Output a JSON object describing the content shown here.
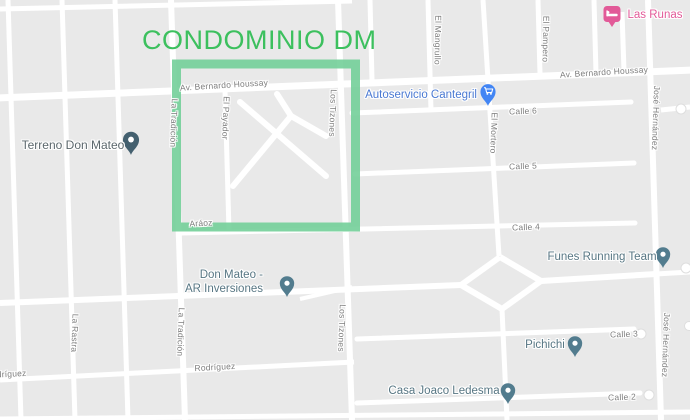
{
  "title": "CONDOMINIO DM",
  "colors": {
    "highlight_green": "#6fce96",
    "title_green": "#3cc05e",
    "road_white": "#ffffff",
    "block_gray": "#e9e9e9",
    "poi_label": "#577683",
    "street_label": "#7e7e7e",
    "shopping_blue": "#4a79d2",
    "lodging_pink": "#e25a98",
    "generic_pin_teal": "#527c8e",
    "terreno_pin_slate": "#44606f"
  },
  "streets": {
    "av_bernardo_houssay": "Av. Bernardo Houssay",
    "calle_6": "Calle 6",
    "calle_5": "Calle 5",
    "calle_4": "Calle 4",
    "calle_3": "Calle 3",
    "calle_2": "Calle 2",
    "araoz": "Aráoz",
    "rodriguez": "Rodríguez",
    "la_tradicion": "La Tradición",
    "la_rastra": "La Rastra",
    "el_payador": "El Payador",
    "los_tizones": "Los Tizones",
    "el_mangrullo": "El Mangrullo",
    "el_pampero": "El Pampero",
    "el_mortero": "El Mortero",
    "jose_hernandez": "José Hernández"
  },
  "pois": {
    "terreno_don_mateo": "Terreno Don Mateo",
    "autoservicio_cantegril": "Autoservicio Cantegril",
    "las_runas": "Las Runas",
    "don_mateo_line1": "Don Mateo -",
    "don_mateo_line2": "AR Inversiones",
    "funes_running_team": "Funes Running Team",
    "pichichi": "Pichichi",
    "casa_joaco_ledesma": "Casa Joaco Ledesma"
  }
}
